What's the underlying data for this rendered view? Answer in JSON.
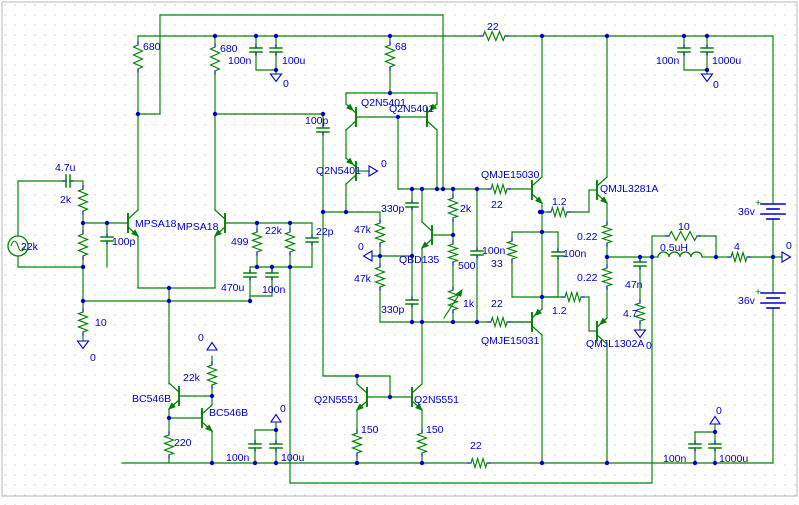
{
  "document": {
    "type": "circuit-schematic",
    "description": "Audio power amplifier schematic with differential input, VAS, bias spreader and complementary output stage"
  },
  "colors": {
    "wire": "#008200",
    "component": "#008200",
    "pin": "#0000cc",
    "junction": "#0000cc",
    "label": "#0000cc",
    "symbol": "#0000cc",
    "grid_dot": "#c9c9c9",
    "background": "#ffffff",
    "border": "#b8b8b8"
  },
  "schematic": {
    "labels": [
      {
        "id": "r680a",
        "text": "680"
      },
      {
        "id": "r680b",
        "text": "680"
      },
      {
        "id": "c100n_tl",
        "text": "100n"
      },
      {
        "id": "c100u_tl",
        "text": "100u"
      },
      {
        "id": "gnd_tl",
        "text": "0"
      },
      {
        "id": "r68",
        "text": "68"
      },
      {
        "id": "r22_rail",
        "text": "22"
      },
      {
        "id": "c100n_tr",
        "text": "100n"
      },
      {
        "id": "c1000u_tr",
        "text": "1000u"
      },
      {
        "id": "gnd_tr",
        "text": "0"
      },
      {
        "id": "q5401a",
        "text": "Q2N5401"
      },
      {
        "id": "q5401b",
        "text": "Q2N5401"
      },
      {
        "id": "c100p_vas",
        "text": "100p"
      },
      {
        "id": "q5401c",
        "text": "Q2N5401"
      },
      {
        "id": "flag_vas",
        "text": "0"
      },
      {
        "id": "mpsa18a",
        "text": "MPSA18"
      },
      {
        "id": "mpsa18b",
        "text": "MPSA18"
      },
      {
        "id": "c4u7",
        "text": "4.7u"
      },
      {
        "id": "r2k_in",
        "text": "2k"
      },
      {
        "id": "r22k_in",
        "text": "22k"
      },
      {
        "id": "c100p_in",
        "text": "100p"
      },
      {
        "id": "r499",
        "text": "499"
      },
      {
        "id": "r22k_fb",
        "text": "22k"
      },
      {
        "id": "c22p",
        "text": "22p"
      },
      {
        "id": "c470u",
        "text": "470u"
      },
      {
        "id": "c100n_fb",
        "text": "100n"
      },
      {
        "id": "r10_in",
        "text": "10"
      },
      {
        "id": "gnd_in",
        "text": "0"
      },
      {
        "id": "r47k_a",
        "text": "47k"
      },
      {
        "id": "flag_47k",
        "text": "0"
      },
      {
        "id": "r47k_b",
        "text": "47k"
      },
      {
        "id": "c330p_a",
        "text": "330p"
      },
      {
        "id": "c330p_b",
        "text": "330p"
      },
      {
        "id": "qbd135",
        "text": "QBD135"
      },
      {
        "id": "r2k_b",
        "text": "2k"
      },
      {
        "id": "r500",
        "text": "500"
      },
      {
        "id": "r1k",
        "text": "1k"
      },
      {
        "id": "c100n_bias",
        "text": "100n"
      },
      {
        "id": "r22_d1",
        "text": "22"
      },
      {
        "id": "qmje15030",
        "text": "QMJE15030"
      },
      {
        "id": "r1_2a",
        "text": "1.2"
      },
      {
        "id": "qmjl3281a",
        "text": "QMJL3281A"
      },
      {
        "id": "r33",
        "text": "33"
      },
      {
        "id": "c100n_mid",
        "text": "100n"
      },
      {
        "id": "r0_22a",
        "text": "0.22"
      },
      {
        "id": "r0_22b",
        "text": "0.22"
      },
      {
        "id": "r22_d2",
        "text": "22"
      },
      {
        "id": "qmje15031",
        "text": "QMJE15031"
      },
      {
        "id": "r1_2b",
        "text": "1.2"
      },
      {
        "id": "qmjl1302a",
        "text": "QMJL1302A"
      },
      {
        "id": "c47n",
        "text": "47n"
      },
      {
        "id": "r4_7",
        "text": "4.7"
      },
      {
        "id": "gnd_out",
        "text": "0"
      },
      {
        "id": "r10_out",
        "text": "10"
      },
      {
        "id": "l0_5",
        "text": "0.5uH"
      },
      {
        "id": "r4",
        "text": "4"
      },
      {
        "id": "v36a",
        "text": "36v"
      },
      {
        "id": "v36b",
        "text": "36v"
      },
      {
        "id": "flag_out",
        "text": "0"
      },
      {
        "id": "bc546ba",
        "text": "BC546B"
      },
      {
        "id": "bc546bb",
        "text": "BC546B"
      },
      {
        "id": "r22k_cs",
        "text": "22k"
      },
      {
        "id": "flag_cs",
        "text": "0"
      },
      {
        "id": "r220",
        "text": "220"
      },
      {
        "id": "c100n_bl",
        "text": "100n"
      },
      {
        "id": "c100u_bl",
        "text": "100u"
      },
      {
        "id": "flag_bl",
        "text": "0"
      },
      {
        "id": "q5551a",
        "text": "Q2N5551"
      },
      {
        "id": "q5551b",
        "text": "Q2N5551"
      },
      {
        "id": "r150a",
        "text": "150"
      },
      {
        "id": "r150b",
        "text": "150"
      },
      {
        "id": "r22_rail2",
        "text": "22"
      },
      {
        "id": "c100n_br",
        "text": "100n"
      },
      {
        "id": "c1000u_br",
        "text": "1000u"
      },
      {
        "id": "flag_br",
        "text": "0"
      },
      {
        "id": "vplus_a",
        "text": "+"
      },
      {
        "id": "vplus_b",
        "text": "+"
      }
    ]
  }
}
